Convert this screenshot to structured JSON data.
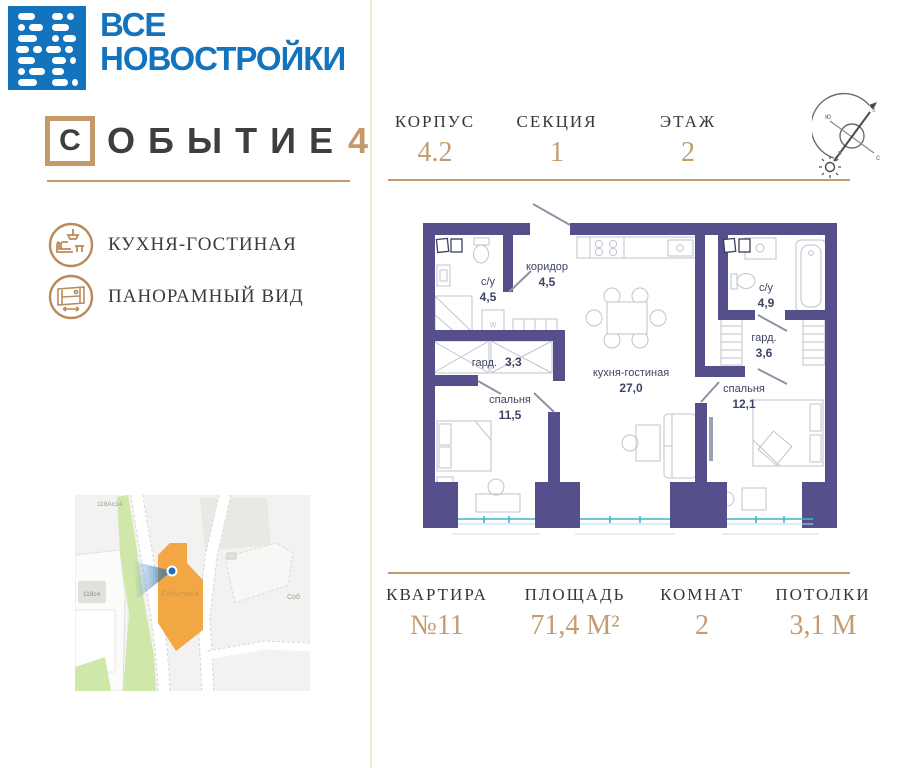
{
  "brand": {
    "line1": "ВСЕ",
    "line2": "НОВОСТРОЙКИ"
  },
  "project": {
    "first_letter": "С",
    "rest": "ОБЫТИЕ",
    "number": "4"
  },
  "features": [
    {
      "icon": "sofa-lamp-icon",
      "label": "КУХНЯ-ГОСТИНАЯ"
    },
    {
      "icon": "panoramic-window-icon",
      "label": "ПАНОРАМНЫЙ ВИД"
    }
  ],
  "header_stats": [
    {
      "label": "КОРПУС",
      "value": "4.2"
    },
    {
      "label": "СЕКЦИЯ",
      "value": "1"
    },
    {
      "label": "ЭТАЖ",
      "value": "2"
    }
  ],
  "compass": {
    "north": "с",
    "south": "ю",
    "west": "з",
    "east": "в"
  },
  "floor_plan": {
    "washer_label": "w",
    "rooms": [
      {
        "name": "с/у",
        "area": "4,5"
      },
      {
        "name": "коридор",
        "area": "4,5"
      },
      {
        "name": "кухня-гостиная",
        "area": "27,0"
      },
      {
        "name": "с/у",
        "area": "4,9"
      },
      {
        "name": "гард.",
        "area": "3,6"
      },
      {
        "name": "гард.",
        "area": "3,3"
      },
      {
        "name": "спальня",
        "area": "11,5"
      },
      {
        "name": "спальня",
        "area": "12,1"
      }
    ]
  },
  "map": {
    "building_label": "Событие-4",
    "labels": [
      "118Ас14",
      "118с4",
      "Соб"
    ]
  },
  "footer_stats": [
    {
      "label": "КВАРТИРА",
      "value": "№11"
    },
    {
      "label": "ПЛОЩАДЬ",
      "value": "71,4 М²"
    },
    {
      "label": "КОМНАТ",
      "value": "2"
    },
    {
      "label": "ПОТОЛКИ",
      "value": "3,1 М"
    }
  ],
  "colors": {
    "brand_blue": "#1373bd",
    "accent_tan": "#c49a6c",
    "wall_purple": "#55508c",
    "plan_text": "#3d4468",
    "window_teal": "#44b4cf",
    "map_building_orange": "#f2a744",
    "map_green": "#cfe8a9",
    "marker_blue": "#1e6fbe"
  }
}
